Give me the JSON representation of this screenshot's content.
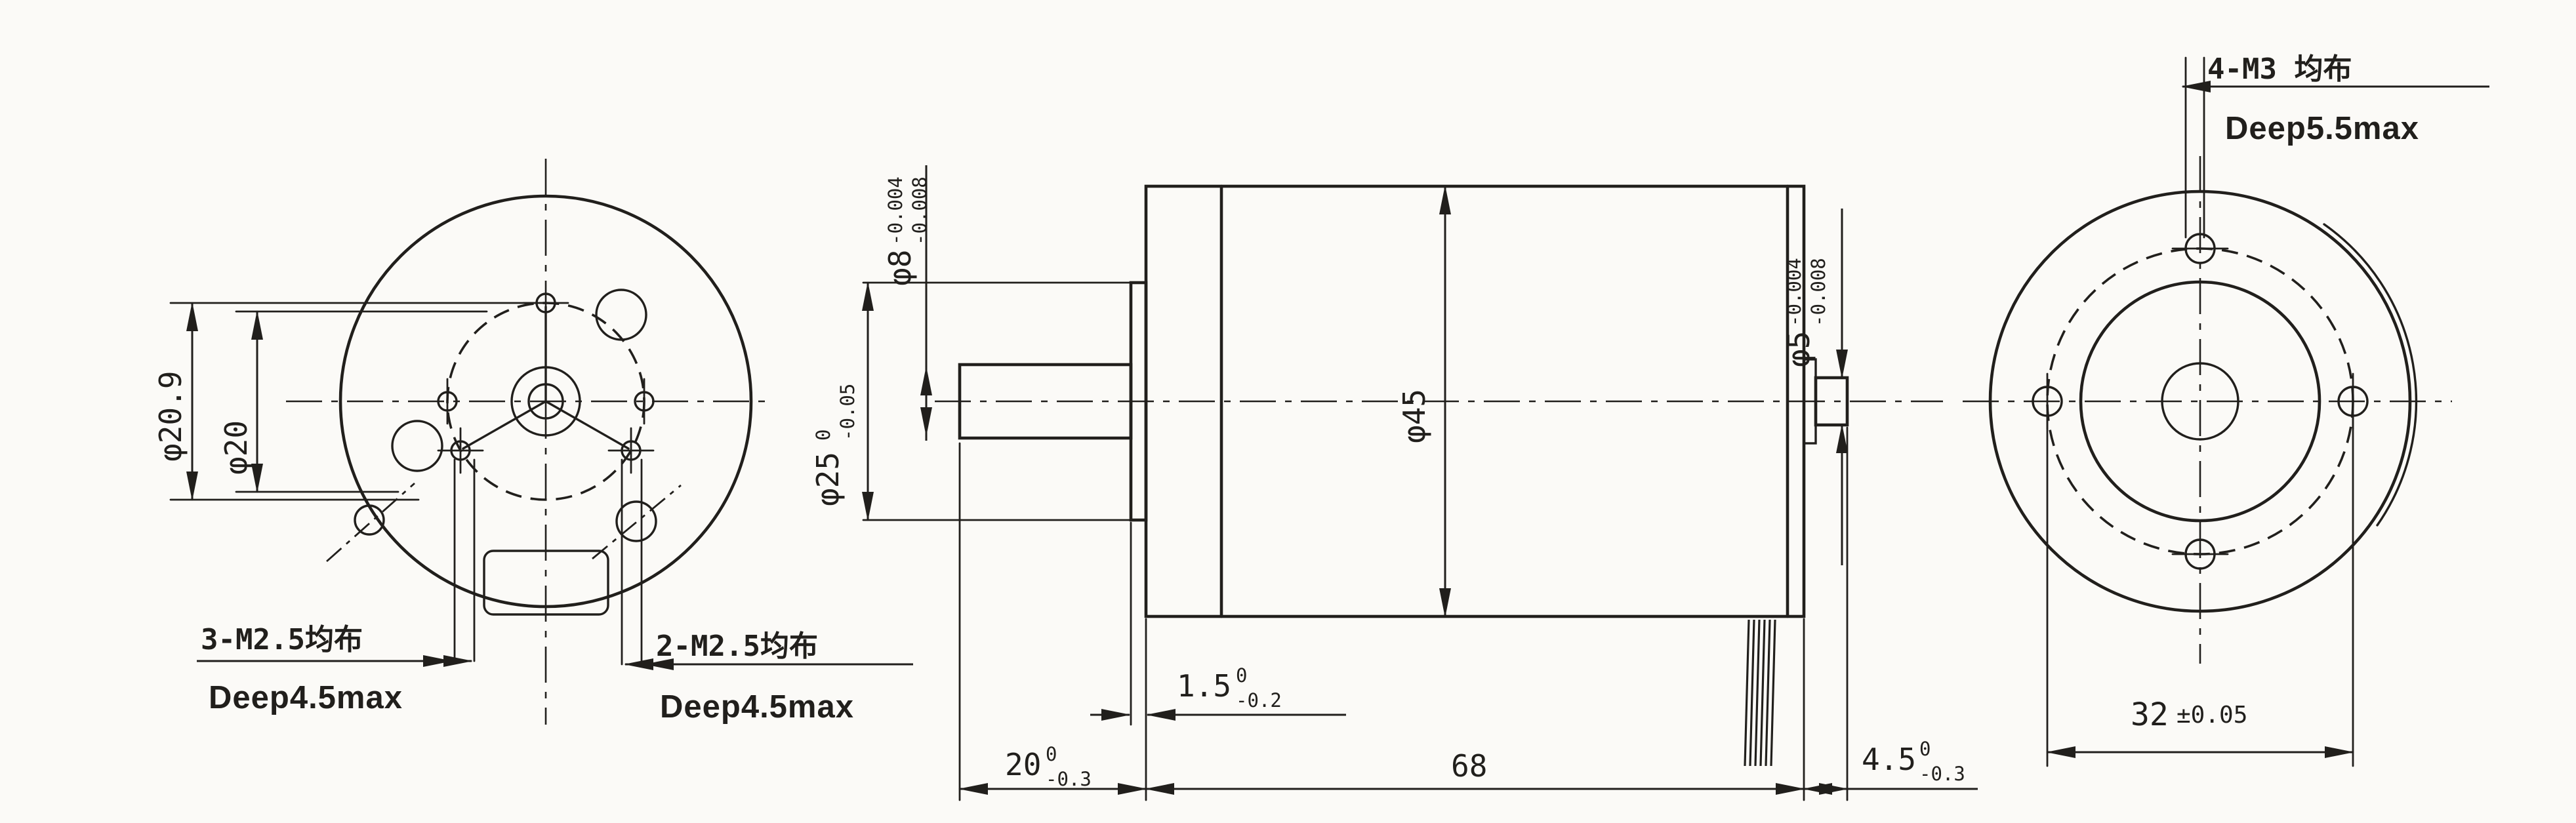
{
  "drawing": {
    "left_view": {
      "dim_outer_bolt_circle": {
        "nominal": "φ20.9"
      },
      "dim_inner_bolt_circle": {
        "nominal": "φ20"
      },
      "note_3xm25": {
        "line1": "3-M2.5均布",
        "line2": "Deep4.5max"
      },
      "note_2xm25": {
        "line1": "2-M2.5均布",
        "line2": "Deep4.5max"
      }
    },
    "side_view": {
      "dim_front_shaft": {
        "nominal": "φ8",
        "tol_upper": "-0.004",
        "tol_lower": "-0.008"
      },
      "dim_pilot_boss": {
        "nominal": "φ25",
        "tol_upper": "0",
        "tol_lower": "-0.05"
      },
      "dim_body_diameter": {
        "nominal": "φ45"
      },
      "dim_rear_shaft": {
        "nominal": "φ5",
        "tol_upper": "-0.004",
        "tol_lower": "-0.008"
      },
      "dim_boss_lip": {
        "nominal": "1.5",
        "tol_upper": "0",
        "tol_lower": "-0.2"
      },
      "dim_front_shaft_length": {
        "nominal": "20",
        "tol_upper": "0",
        "tol_lower": "-0.3"
      },
      "dim_body_length": {
        "nominal": "68"
      },
      "dim_rear_shaft_length": {
        "nominal": "4.5",
        "tol_upper": "0",
        "tol_lower": "-0.3"
      }
    },
    "right_view": {
      "note_4xm3": {
        "line1": "4-M3 均布",
        "line2": "Deep5.5max"
      },
      "dim_mounting_span": {
        "nominal": "32",
        "tolerance": "±0.05"
      }
    }
  },
  "colors": {
    "ink": "#211f1c",
    "paper": "#fbfaf7"
  }
}
